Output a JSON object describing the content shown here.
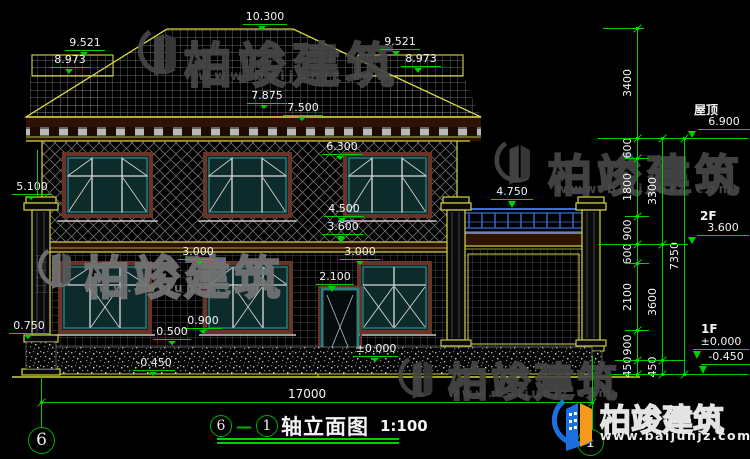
{
  "colors": {
    "background": "#000000",
    "dimension_green": "#00cf00",
    "cad_yellow": "#d6d640",
    "window_teal": "#2f7d7d",
    "frame_brown": "#6b3226",
    "railing_blue": "#3a6fd6",
    "watermark_gray": "#474747",
    "logo_blue": "#1d6fe0",
    "logo_orange": "#f59a1d",
    "label_white": "#f4f4f4"
  },
  "watermarks": {
    "brand": "柏竣建筑",
    "url": "www.baijunjz.com"
  },
  "brand_logo": {
    "brand": "柏竣建筑",
    "url": "www.baijunjz.com"
  },
  "title_bar": {
    "bubble_left": "6",
    "dash": "—",
    "bubble_right": "1",
    "name": "轴立面图",
    "scale": "1:100"
  },
  "axis_bubbles": [
    {
      "n": "6",
      "x": 28,
      "y": 427,
      "d": 25
    },
    {
      "n": "1",
      "x": 577,
      "y": 429,
      "d": 25
    }
  ],
  "markers": [
    {
      "v": "10.300",
      "x": 243,
      "y": 11,
      "tx": 262,
      "ty": 29,
      "w": 44
    },
    {
      "v": "9.521",
      "x": 65,
      "y": 37,
      "tx": 84,
      "ty": 55,
      "w": 40
    },
    {
      "v": "8.973",
      "x": 50,
      "y": 54,
      "tx": 69,
      "ty": 74,
      "w": 40
    },
    {
      "v": "9.521",
      "x": 380,
      "y": 36,
      "tx": 396,
      "ty": 56,
      "w": 40
    },
    {
      "v": "8.973",
      "x": 401,
      "y": 53,
      "tx": 418,
      "ty": 73,
      "w": 40
    },
    {
      "v": "7.875",
      "x": 247,
      "y": 90,
      "tx": 264,
      "ty": 108,
      "w": 40
    },
    {
      "v": "7.500",
      "x": 283,
      "y": 102,
      "tx": 302,
      "ty": 118,
      "w": 40
    },
    {
      "v": "6.300",
      "x": 322,
      "y": 141,
      "tx": 340,
      "ty": 158,
      "w": 40
    },
    {
      "v": "5.100",
      "x": 12,
      "y": 181,
      "tx": 31,
      "ty": 197,
      "w": 40
    },
    {
      "v": "4.750",
      "x": 491,
      "y": 186,
      "tx": 512,
      "ty": 208,
      "w": 42
    },
    {
      "v": "4.500",
      "x": 324,
      "y": 203,
      "tx": 342,
      "ty": 217,
      "w": 40
    },
    {
      "v": "3.600",
      "x": 323,
      "y": 221,
      "tx": 341,
      "ty": 244,
      "w": 40
    },
    {
      "v": "3.000",
      "x": 178,
      "y": 246,
      "tx": 200,
      "ty": 263,
      "w": 40
    },
    {
      "v": "3.000",
      "x": 340,
      "y": 246,
      "tx": 360,
      "ty": 263,
      "w": 40
    },
    {
      "v": "2.100",
      "x": 316,
      "y": 271,
      "tx": 332,
      "ty": 292,
      "w": 38
    },
    {
      "v": "0.900",
      "x": 184,
      "y": 315,
      "tx": 203,
      "ty": 330,
      "w": 38
    },
    {
      "v": "0.500",
      "x": 153,
      "y": 326,
      "tx": 172,
      "ty": 343,
      "w": 38
    },
    {
      "v": "0.750",
      "x": 9,
      "y": 320,
      "tx": 28,
      "ty": 336,
      "w": 40
    },
    {
      "v": "±0.000",
      "x": 354,
      "y": 343,
      "tx": 375,
      "ty": 360,
      "w": 44
    },
    {
      "v": "-0.450",
      "x": 133,
      "y": 357,
      "tx": 153,
      "ty": 374,
      "w": 42
    },
    {
      "v": "6.900",
      "x": 698,
      "y": 116,
      "tx": 692,
      "ty": 138,
      "w": 52
    },
    {
      "v": "3.600",
      "x": 697,
      "y": 222,
      "tx": 692,
      "ty": 244,
      "w": 52
    },
    {
      "v": "±0.000",
      "x": 693,
      "y": 336,
      "tx": 697,
      "ty": 359,
      "w": 56
    },
    {
      "v": "-0.450",
      "x": 701,
      "y": 351,
      "tx": 703,
      "ty": 374,
      "w": 50
    }
  ],
  "level_labels": [
    {
      "t": "屋顶",
      "x": 694,
      "y": 101
    },
    {
      "t": "2F",
      "x": 700,
      "y": 209
    },
    {
      "t": "1F",
      "x": 701,
      "y": 322
    }
  ],
  "chains": [
    {
      "x": 637,
      "bounds": [
        28,
        138,
        158,
        216,
        244,
        263,
        330,
        360,
        374
      ],
      "labels": [
        "3400",
        "600",
        "1800",
        "900",
        "600",
        "2100",
        "900",
        "450"
      ]
    },
    {
      "x": 662,
      "bounds": [
        138,
        244,
        360,
        374
      ],
      "labels": [
        "3300",
        "3600",
        "450"
      ]
    },
    {
      "x": 684,
      "bounds": [
        138,
        374
      ],
      "labels": [
        "7350"
      ]
    }
  ],
  "tick_lines": [
    {
      "x": 603,
      "y": 28,
      "w": 40
    },
    {
      "x": 598,
      "y": 138,
      "w": 150
    },
    {
      "x": 625,
      "y": 158,
      "w": 24
    },
    {
      "x": 625,
      "y": 216,
      "w": 24
    },
    {
      "x": 598,
      "y": 244,
      "w": 90
    },
    {
      "x": 625,
      "y": 263,
      "w": 24
    },
    {
      "x": 625,
      "y": 330,
      "w": 24
    },
    {
      "x": 615,
      "y": 360,
      "w": 70
    },
    {
      "x": 612,
      "y": 374,
      "w": 136
    }
  ],
  "ext_lines": [
    {
      "x": 37,
      "y": 150,
      "h": 46
    },
    {
      "x": 41,
      "y": 377,
      "h": 50
    },
    {
      "x": 592,
      "y": 356,
      "h": 74
    }
  ],
  "h_dim": {
    "label": "17000",
    "x1": 41,
    "x2": 592,
    "y": 402,
    "lx": 288,
    "ly": 387
  }
}
